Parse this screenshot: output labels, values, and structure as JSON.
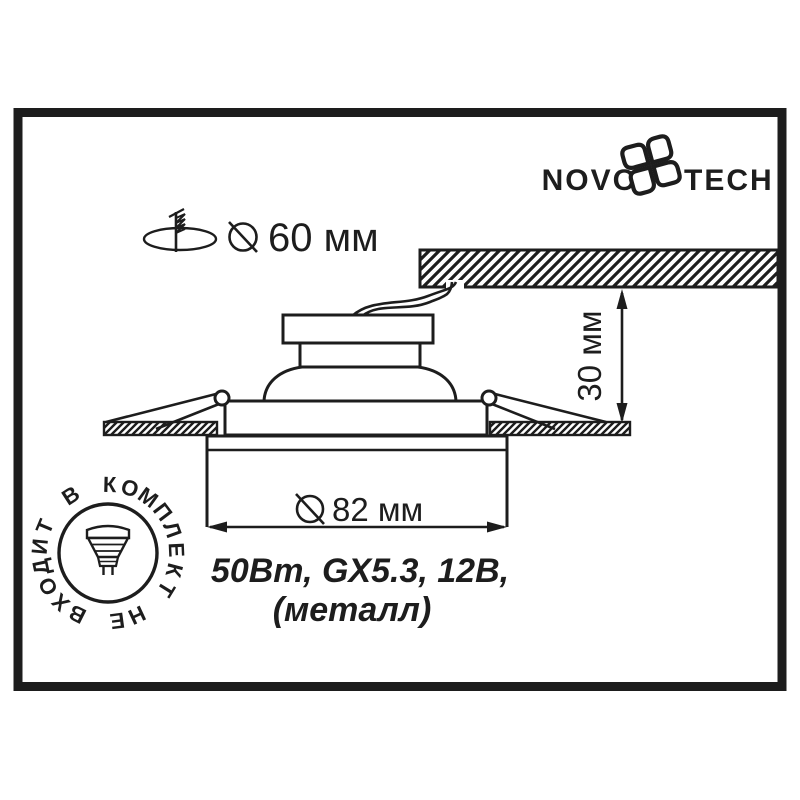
{
  "colors": {
    "ink": "#1d1d1d",
    "background": "#ffffff"
  },
  "logo": {
    "word_left": "NOVO",
    "word_right": "TECH",
    "flower_icon": "novotech-flower-icon"
  },
  "cutout_note": {
    "hole_icon": "mounting-hole-icon",
    "screw_icon": "screw-icon",
    "diameter_icon": "diameter-icon",
    "label": "60 мм"
  },
  "dimensions": {
    "recess_depth": {
      "label": "30 мм",
      "orientation": "vertical"
    },
    "outer_diameter": {
      "label": "82 мм",
      "diameter_icon": "diameter-icon"
    }
  },
  "spec": {
    "line1": "50Вт, GX5.3, 12В,",
    "line2": "(металл)"
  },
  "stamp": {
    "text": "НЕ ВХОДИТ В КОМПЛЕКТ",
    "lamp_icon": "mr16-lamp-icon"
  }
}
